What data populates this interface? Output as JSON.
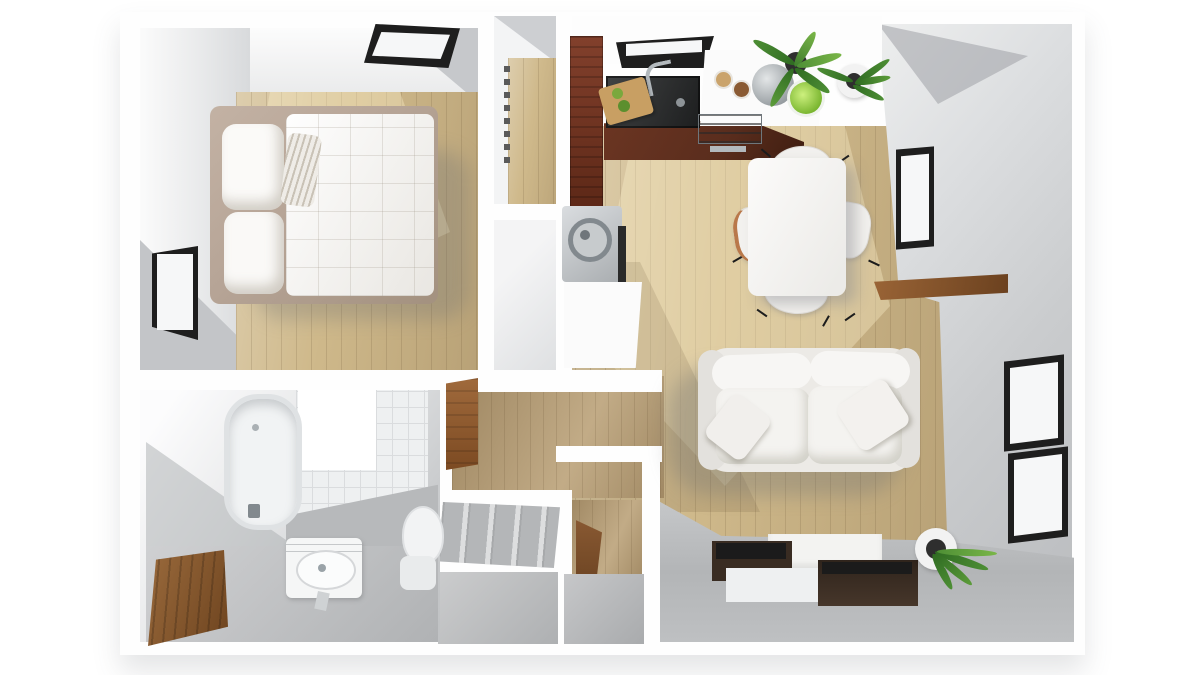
{
  "meta": {
    "type": "3d-floorplan-render",
    "description": "Top-down 3D rendered floor plan of a one-bedroom apartment with bedroom, walk-in closet, kitchen, dining area, living room, laundry nook, entry and bathroom",
    "canvas": {
      "width": 1200,
      "height": 675
    }
  },
  "palette": {
    "bg": "#ffffff",
    "wall-white": "#fefefe",
    "wall-face": "#d5d7d9",
    "wall-face-dark": "#c2c4c7",
    "floor-gray": "#b7b9bb",
    "tile-base": "#eef0f1",
    "tile-line": "#dadcde",
    "wood-base": "#cfb98b",
    "wood-light": "#e2cda0",
    "wood-dark": "#b59e73",
    "wood-hall": "#bba279",
    "plank-line": "rgba(92,70,40,0.16)",
    "mahogany": "#82402c",
    "mahogany-dark": "#5d2817",
    "counter-dark": "#5a2d1d",
    "sink-black": "#2c2e2f",
    "steel": "#b3b9bd",
    "steel-dark": "#82898e",
    "furniture-white": "#f4f3f1",
    "bed-frame": "#b6a496",
    "espresso": "#392c22",
    "espresso-top": "#1b1b1b",
    "frame-black": "#1e1e1e",
    "glass-white": "#f6f7f8",
    "leaf": "#4e8f35",
    "leaf-dark": "#2f6b22",
    "leaf-light": "#7ab648",
    "pot-white": "#f2f2f2",
    "pot-dark": "#2e2e2e",
    "door-wood": "#8a5a33",
    "door-wood-dark": "#6b411f",
    "sun": "rgba(255,243,205,0.35)"
  },
  "rooms": {
    "bedroom": {
      "furniture": [
        "double-bed",
        "pillows-x2",
        "accent-pillow",
        "skylight-window",
        "side-window"
      ]
    },
    "closet": {
      "furniture": [
        "closet-rail"
      ]
    },
    "kitchen": {
      "furniture": [
        "tall-cabinet",
        "black-sink",
        "faucet",
        "cutting-board",
        "white-island",
        "stove-grill",
        "gray-bowl",
        "green-bowl",
        "jars-x2",
        "potted-plant",
        "corner-plant"
      ]
    },
    "dining": {
      "furniture": [
        "dining-table",
        "chairs-x4",
        "wall-window"
      ]
    },
    "living": {
      "furniture": [
        "sofa",
        "throw-pillows-x2",
        "tv-console-modules-x4",
        "floor-plant",
        "stacked-windows-x2",
        "wood-ledge"
      ]
    },
    "laundry": {
      "furniture": [
        "washing-machine",
        "white-counter"
      ]
    },
    "entry": {
      "furniture": [
        "wall-cabinet",
        "entry-step",
        "open-wood-door"
      ]
    },
    "bathroom": {
      "furniture": [
        "bathtub",
        "vanity-sink",
        "toilet",
        "tiled-wall",
        "wood-closet-door"
      ]
    }
  },
  "counts": {
    "windows": 5,
    "plants": 3,
    "rooms": 8
  }
}
